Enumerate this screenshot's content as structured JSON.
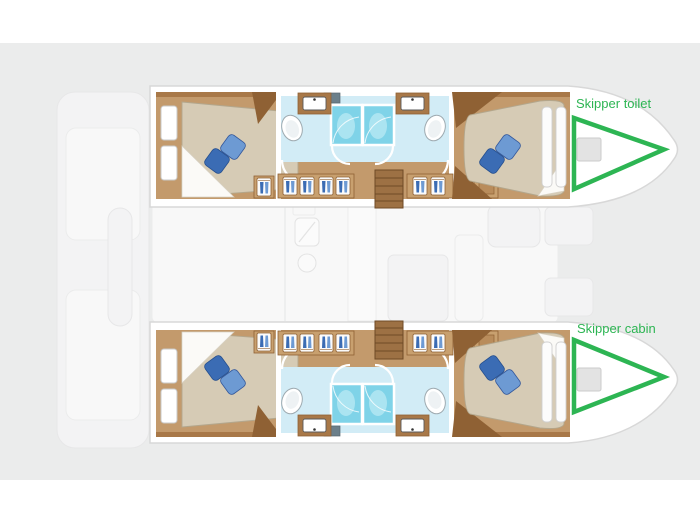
{
  "canvas": {
    "width": 700,
    "height": 525,
    "background": "#ffffff"
  },
  "colors": {
    "panel": "#ebecec",
    "annotation_green": "#2db553",
    "hull_floor": "#c39a6c",
    "wood_dark": "#8f6134",
    "wood_mid": "#a87848",
    "cabinet_tan": "#c8a06f",
    "bed_beige": "#d6cbb5",
    "pillow_light": "#6d9ad3",
    "pillow_dark": "#3b6cb4",
    "bath_floor": "#d2ecf6",
    "shower_cyan": "#7fd3e8",
    "faded_fill": "#f4f4f5",
    "faded_stroke": "#e7e7e8",
    "hull_outline": "#d8d8d8"
  },
  "annotations": {
    "skipper_toilet": {
      "label": "Skipper toilet"
    },
    "skipper_cabin": {
      "label": "Skipper cabin"
    }
  },
  "icons": {
    "wardrobe": "hanging-clothes glyph (blue garments in cabinet)",
    "toilet": "white oval bowl",
    "sink": "white basin on wood counter",
    "shower": "cyan stall with glass front",
    "stairs": "stepped wood rectangle",
    "pillow": "rotated blue square",
    "bow_arrow": "green outlined triangle pointing to bow"
  }
}
